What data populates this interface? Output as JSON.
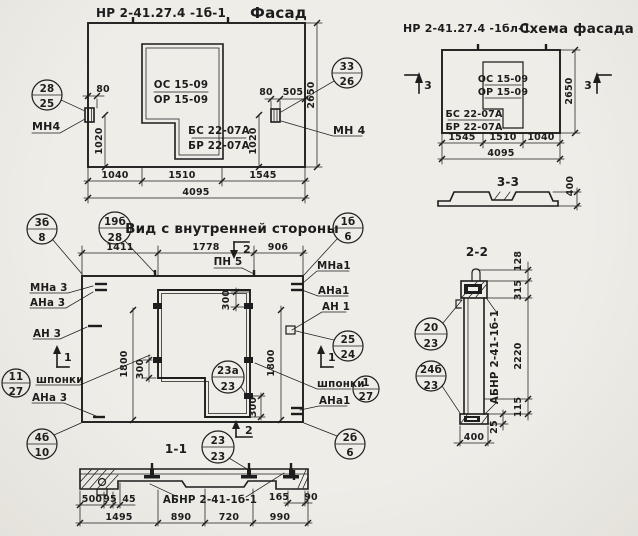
{
  "colors": {
    "paper": "#efede8",
    "ink": "#1d1d1d"
  },
  "facade": {
    "title_code": "НР 2-41.27.4 -1б-1",
    "title_name": "Фасад",
    "win_top": "ОС 15-09",
    "win_bot": "ОР 15-09",
    "sill_top": "БС 22-07А",
    "sill_bot": "БР 22-07А",
    "mn_left": "МН4",
    "mn_right": "МН 4",
    "d80l": "80",
    "d1020l": "1020",
    "d80r": "80",
    "d505": "505",
    "d2650": "2650",
    "d1020r": "1020",
    "dw1": "1040",
    "dw2": "1510",
    "dw3": "1545",
    "dtot": "4095"
  },
  "schema": {
    "title_code": "НР 2-41.27.4 -1бл-1",
    "title_name": "Схема фасада",
    "win_top": "ОС 15-09",
    "win_bot": "ОР 15-09",
    "sill_top": "БС 22-07А",
    "sill_bot": "БР 22-07А",
    "mark": "3",
    "d2650": "2650",
    "dw1": "1545",
    "dw2": "1510",
    "dw3": "1040",
    "dtot": "4095",
    "sec_label": "3-3",
    "d400": "400"
  },
  "inner": {
    "title": "Вид с внутренней стороны",
    "pn5": "ПН 5",
    "mark1": "1",
    "mark2": "2",
    "mna3": "МНа 3",
    "ana3": "АНа 3",
    "an3": "АН 3",
    "shponki": "шпонки",
    "ana3b": "АНа 3",
    "mna1": "МНа1",
    "ana1": "АНа1",
    "an1": "АН 1",
    "shponki_r": "шпонки",
    "ana1b": "АНа1",
    "d1411": "1411",
    "d1778": "1778",
    "d906": "906",
    "d300a": "300",
    "d300b": "300",
    "d300c": "300",
    "d1800l": "1800",
    "d1800r": "1800"
  },
  "s11": {
    "label": "1-1",
    "part": "АБНР 2-41-1б-1",
    "d500": "500",
    "d95": "95",
    "d45": "45",
    "d1495": "1495",
    "d890": "890",
    "d720": "720",
    "d990": "990",
    "d165": "165",
    "d90": "90"
  },
  "s22": {
    "label": "2-2",
    "part": "АБНР 2-41-1б-1",
    "d128": "128",
    "d315": "315",
    "d2220": "2220",
    "d115": "115",
    "d25": "25",
    "d400": "400"
  },
  "callouts": {
    "c28": {
      "t": "28",
      "b": "25"
    },
    "c33": {
      "t": "33",
      "b": "26"
    },
    "c3b": {
      "t": "3б",
      "b": "8"
    },
    "c19b": {
      "t": "19б",
      "b": "28"
    },
    "c1b": {
      "t": "1б",
      "b": "6"
    },
    "c25": {
      "t": "25",
      "b": "24"
    },
    "c11": {
      "t": "11",
      "b": "27"
    },
    "c1": {
      "t": "1",
      "b": "27"
    },
    "c23a": {
      "t": "23а",
      "b": "23"
    },
    "c4b": {
      "t": "4б",
      "b": "10"
    },
    "c2b": {
      "t": "2б",
      "b": "6"
    },
    "c23": {
      "t": "23",
      "b": "23"
    },
    "c20": {
      "t": "20",
      "b": "23"
    },
    "c24b": {
      "t": "24б",
      "b": "23"
    }
  }
}
